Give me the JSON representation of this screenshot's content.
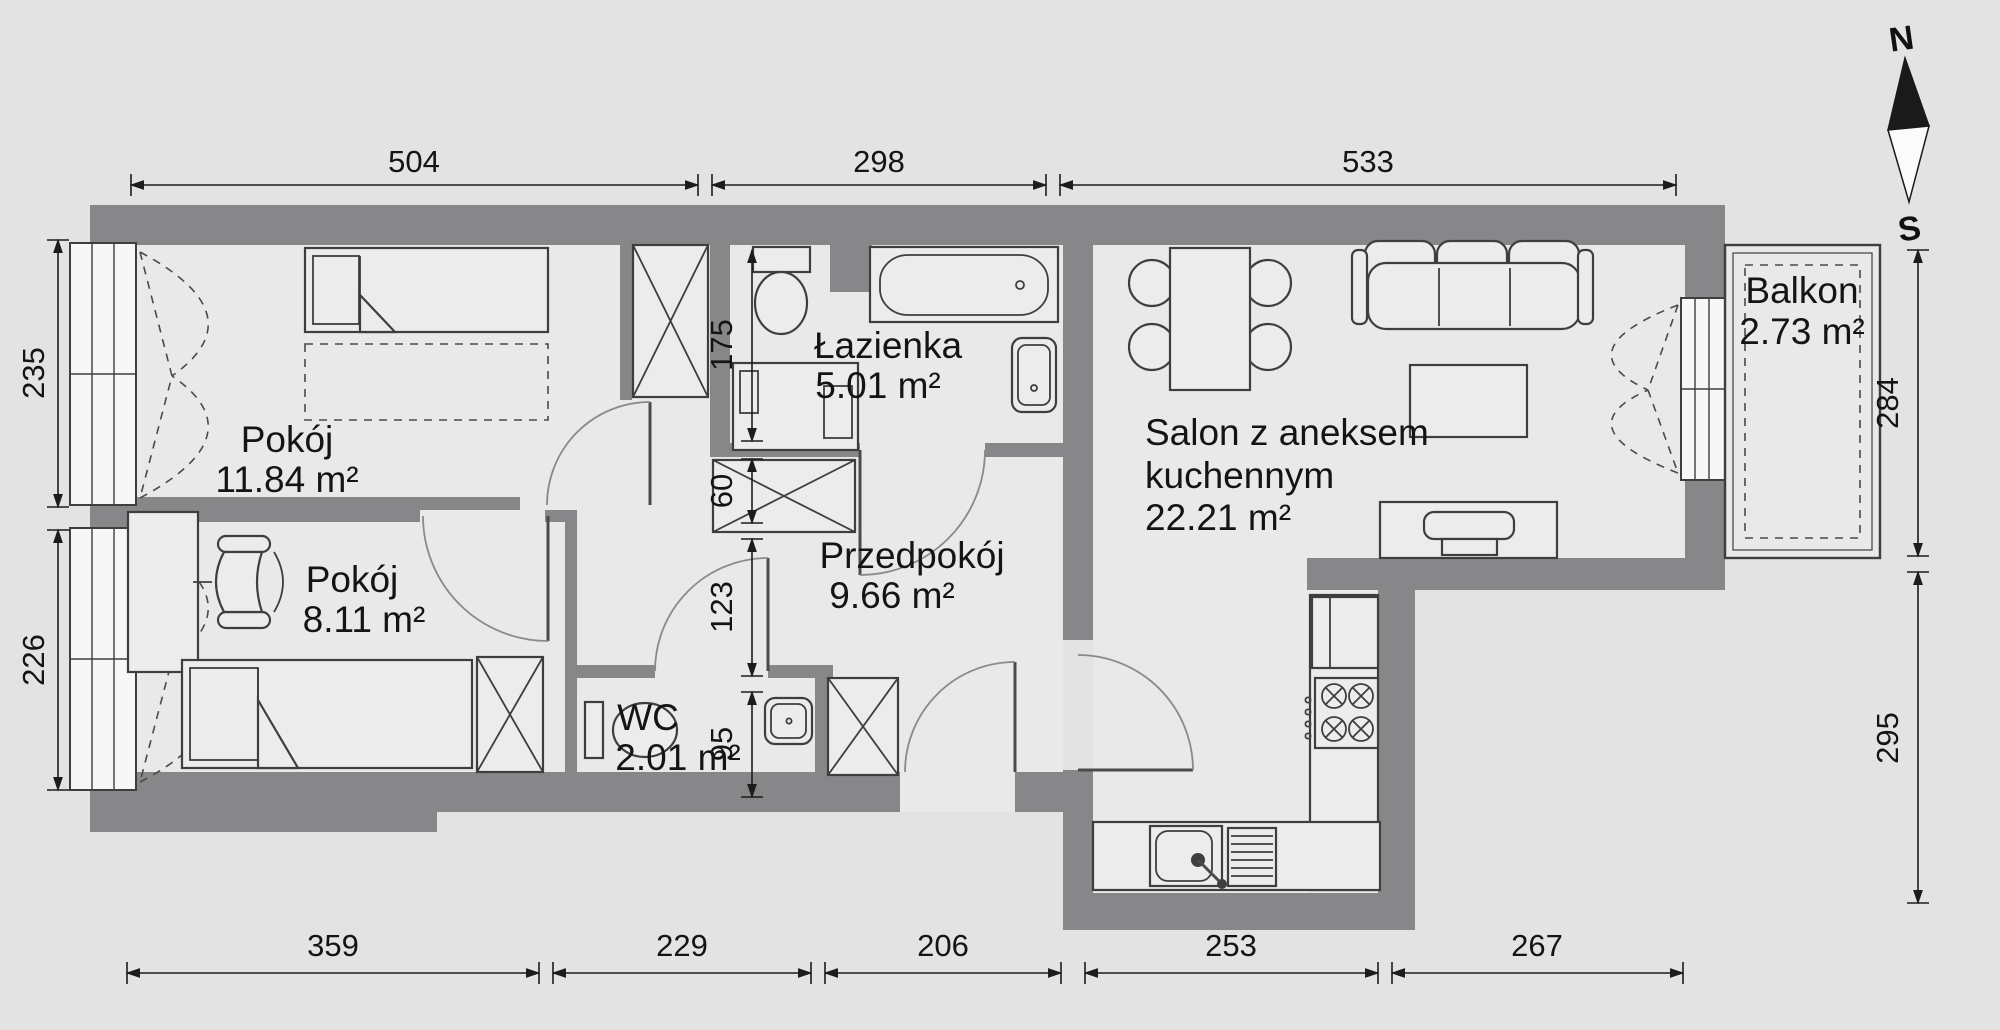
{
  "plan": {
    "compass": {
      "north": "N",
      "south": "S"
    },
    "rooms": {
      "pokoj1": {
        "name": "Pokój",
        "area": "11.84 m²"
      },
      "pokoj2": {
        "name": "Pokój",
        "area": "8.11 m²"
      },
      "lazienka": {
        "name": "Łazienka",
        "area": "5.01 m²"
      },
      "przedpokoj": {
        "name": "Przedpokój",
        "area": "9.66 m²"
      },
      "wc": {
        "name": "WC",
        "area": "2.01 m²"
      },
      "salon": {
        "name_line1": "Salon z aneksem",
        "name_line2": "kuchennym",
        "area": "22.21 m²"
      },
      "balkon": {
        "name": "Balkon",
        "area": "2.73 m²"
      }
    },
    "dimensions": {
      "top": [
        "504",
        "298",
        "533"
      ],
      "bottom": [
        "359",
        "229",
        "206",
        "253",
        "267"
      ],
      "left": [
        "235",
        "226"
      ],
      "right": [
        "284",
        "295"
      ],
      "inner": [
        "175",
        "60",
        "123",
        "95"
      ]
    },
    "colors": {
      "wall": "#87878a",
      "floor": "#e9e9e9",
      "background": "#e3e3e3"
    }
  }
}
